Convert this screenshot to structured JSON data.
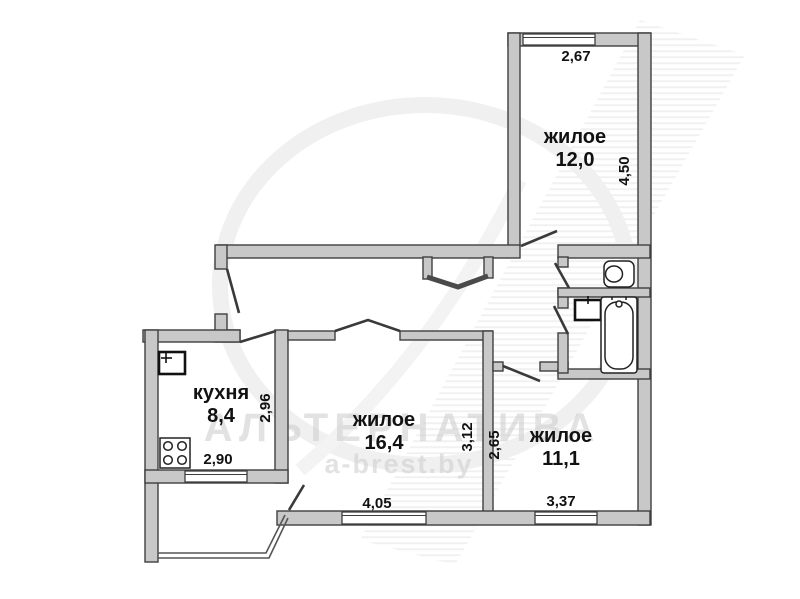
{
  "watermark": {
    "brand": "АЛЬТЕРНАТИВА",
    "site": "a-brest.by"
  },
  "rooms": {
    "living_top": {
      "name": "жилое",
      "area": "12,0",
      "dim_top": "2,67",
      "dim_side": "4,50"
    },
    "kitchen": {
      "name": "кухня",
      "area": "8,4",
      "dim_side": "2,96",
      "dim_bottom": "2,90"
    },
    "living_middle": {
      "name": "жилое",
      "area": "16,4",
      "dim_side": "3,12",
      "dim_bottom": "4,05"
    },
    "living_right": {
      "name": "жилое",
      "area": "11,1",
      "dim_side": "2,65",
      "dim_bottom": "3,37"
    }
  },
  "colors": {
    "wall_fill": "#c8c8c8",
    "wall_stroke": "#3f3f3f",
    "label": "#111111",
    "watermark": "#cfcfcf"
  }
}
